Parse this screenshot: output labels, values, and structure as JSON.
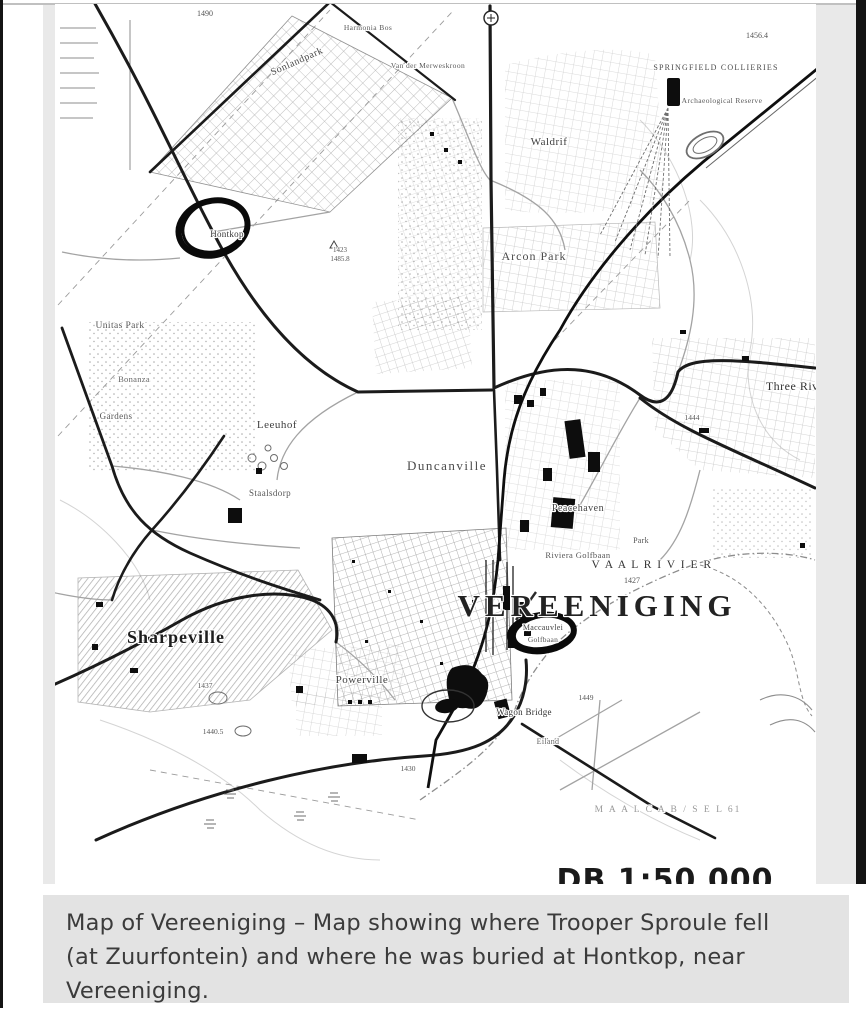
{
  "caption": {
    "lines": [
      "Map of Vereeniging – Map showing where Trooper Sproule fell",
      "(at Zuurfontein) and where he was buried at Hontkop, near",
      "Vereeniging."
    ],
    "bg_color": "#e3e3e3",
    "text_color": "#3b3b3b"
  },
  "map": {
    "title": "VEREENIGING",
    "annotations": [
      {
        "id": "hontkop-circle",
        "meaning": "hand-drawn circle at Hontkop"
      },
      {
        "id": "maccauvlei-circle",
        "meaning": "hand-drawn circle near Vereeniging"
      }
    ],
    "ink_color": "#1b1b1b",
    "labels": [
      {
        "id": "vereeniging",
        "text": "VEREENIGING",
        "x": 597,
        "y": 616,
        "size": 31,
        "ls": 5,
        "color": "#222222",
        "bold": true
      },
      {
        "id": "sharpeville",
        "text": "Sharpeville",
        "x": 176,
        "y": 643,
        "size": 18,
        "ls": 1,
        "color": "#1d1d1d",
        "bold": true
      },
      {
        "id": "duncanville",
        "text": "Duncanville",
        "x": 447,
        "y": 470,
        "size": 13,
        "ls": 1.5,
        "color": "#4a4a4a"
      },
      {
        "id": "arcon-park",
        "text": "Arcon Park",
        "x": 534,
        "y": 260,
        "size": 12,
        "ls": 1,
        "color": "#4a4a4a"
      },
      {
        "id": "leeuhof",
        "text": "Leeuhof",
        "x": 277,
        "y": 428,
        "size": 11,
        "ls": 0.5,
        "color": "#3f3f3f"
      },
      {
        "id": "waldrif",
        "text": "Waldrif",
        "x": 549,
        "y": 145,
        "size": 11,
        "ls": 0.5,
        "color": "#3f3f3f"
      },
      {
        "id": "sonlandpark",
        "text": "Sonlandpark",
        "x": 298,
        "y": 64,
        "size": 10,
        "ls": 0.5,
        "color": "#474747",
        "rot": -24
      },
      {
        "id": "three-rivers",
        "text": "Three Rivers",
        "x": 800,
        "y": 390,
        "size": 12,
        "ls": 0.5,
        "color": "#333333"
      },
      {
        "id": "vaalrivier",
        "text": "V A A L R I V I E R",
        "x": 652,
        "y": 568,
        "size": 11.5,
        "ls": 1.5,
        "color": "#333333"
      },
      {
        "id": "peacehaven",
        "text": "Peacehaven",
        "x": 578,
        "y": 511,
        "size": 10,
        "ls": 0.5,
        "color": "#454545"
      },
      {
        "id": "riviera-golfbaan",
        "text": "Riviera Golfbaan",
        "x": 578,
        "y": 558,
        "size": 8.5,
        "ls": 0.4,
        "color": "#555555"
      },
      {
        "id": "powerville",
        "text": "Powerville",
        "x": 362,
        "y": 683,
        "size": 11,
        "ls": 0.5,
        "color": "#3f3f3f"
      },
      {
        "id": "staalsdorp",
        "text": "Staalsdorp",
        "x": 270,
        "y": 496,
        "size": 9,
        "ls": 0.4,
        "color": "#555555"
      },
      {
        "id": "maccauvlei",
        "text": "Maccauvlei",
        "x": 543,
        "y": 630,
        "size": 8,
        "ls": 0.3,
        "color": "#444444"
      },
      {
        "id": "golfbaan",
        "text": "Golfbaan",
        "x": 543,
        "y": 642,
        "size": 7.5,
        "ls": 0.3,
        "color": "#555555"
      },
      {
        "id": "hontkop",
        "text": "Hontkop",
        "x": 227,
        "y": 237,
        "size": 9,
        "ls": 0.3,
        "color": "#333333"
      },
      {
        "id": "unitas-park",
        "text": "Unitas Park",
        "x": 120,
        "y": 328,
        "size": 9.5,
        "ls": 0.4,
        "color": "#555555"
      },
      {
        "id": "gardens",
        "text": "Gardens",
        "x": 116,
        "y": 419,
        "size": 9,
        "ls": 0.4,
        "color": "#555555"
      },
      {
        "id": "bonanza",
        "text": "Bonanza",
        "x": 134,
        "y": 382,
        "size": 8.5,
        "ls": 0.3,
        "color": "#666666"
      },
      {
        "id": "springfield-collieries",
        "text": "SPRINGFIELD COLLIERIES",
        "x": 716,
        "y": 70,
        "size": 8,
        "ls": 1.2,
        "color": "#4a4a4a"
      },
      {
        "id": "archaeological-reserve",
        "text": "Archaeological Reserve",
        "x": 722,
        "y": 103,
        "size": 7.5,
        "ls": 0.4,
        "color": "#5a5a5a"
      },
      {
        "id": "van-der-merweskroon",
        "text": "Van der Merweskroon",
        "x": 428,
        "y": 68,
        "size": 7.5,
        "ls": 0.4,
        "color": "#5a5a5a"
      },
      {
        "id": "harmonia-bos",
        "text": "Harmonia Bos",
        "x": 368,
        "y": 30,
        "size": 7.5,
        "ls": 0.4,
        "color": "#5a5a5a"
      },
      {
        "id": "wagon-bridge",
        "text": "Wagon Bridge",
        "x": 524,
        "y": 715,
        "size": 9,
        "ls": 0.3,
        "color": "#333333"
      },
      {
        "id": "eiland",
        "text": "Eiland",
        "x": 548,
        "y": 744,
        "size": 8,
        "ls": 0.3,
        "color": "#666666"
      },
      {
        "id": "park",
        "text": "Park",
        "x": 641,
        "y": 543,
        "size": 8,
        "ls": 0.3,
        "color": "#555555"
      },
      {
        "id": "scale-note",
        "text": "DB 1:50 000",
        "x": 665,
        "y": 890,
        "size": 30,
        "ls": 1,
        "color": "#1a1a1a",
        "font": "sans",
        "bold": true
      },
      {
        "id": "farm-name",
        "text": "M A A L C A B / S E L 61",
        "x": 668,
        "y": 812,
        "size": 9.5,
        "ls": 2,
        "color": "#999999"
      },
      {
        "id": "spot-1490",
        "text": "1490",
        "x": 205,
        "y": 16,
        "size": 8,
        "color": "#555555"
      },
      {
        "id": "spot-1456",
        "text": "1456.4",
        "x": 757,
        "y": 38,
        "size": 8,
        "color": "#555555"
      },
      {
        "id": "spot-1427",
        "text": "1427",
        "x": 632,
        "y": 583,
        "size": 8,
        "color": "#555555"
      },
      {
        "id": "spot-1423",
        "text": "1423",
        "x": 340,
        "y": 252,
        "size": 7,
        "color": "#555555"
      },
      {
        "id": "spot-1485",
        "text": "1485.8",
        "x": 340,
        "y": 261,
        "size": 7,
        "color": "#555555"
      },
      {
        "id": "spot-1437",
        "text": "1437",
        "x": 205,
        "y": 688,
        "size": 7.5,
        "color": "#555555"
      },
      {
        "id": "spot-1440",
        "text": "1440.5",
        "x": 213,
        "y": 734,
        "size": 7.5,
        "color": "#555555"
      },
      {
        "id": "spot-1430",
        "text": "1430",
        "x": 408,
        "y": 771,
        "size": 7.5,
        "color": "#555555"
      },
      {
        "id": "spot-1449",
        "text": "1449",
        "x": 586,
        "y": 700,
        "size": 7.5,
        "color": "#555555"
      },
      {
        "id": "spot-1444",
        "text": "1444",
        "x": 692,
        "y": 420,
        "size": 7.5,
        "color": "#555555"
      }
    ]
  }
}
